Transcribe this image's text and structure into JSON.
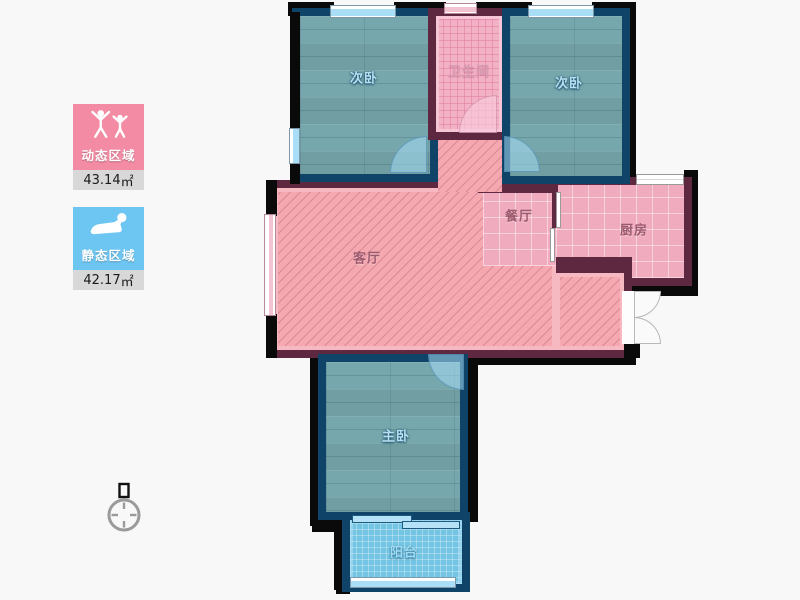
{
  "page": {
    "background": "#f8f8f8"
  },
  "legend": {
    "dynamic_zone": {
      "label": "动态区域",
      "area_value": "43.14",
      "area_unit": "㎡",
      "color": "#f28ba3",
      "icon": "active-people-icon"
    },
    "static_zone": {
      "label": "静态区域",
      "area_value": "42.17",
      "area_unit": "㎡",
      "color": "#6dc5f1",
      "icon": "resting-person-icon"
    }
  },
  "compass": {
    "icon": "north-compass-icon"
  },
  "floorplan": {
    "rooms": {
      "bedroom_top_left": {
        "label": "次卧",
        "type": "bedroom"
      },
      "bathroom": {
        "label": "卫生间",
        "type": "bathroom"
      },
      "bedroom_top_right": {
        "label": "次卧",
        "type": "bedroom"
      },
      "dining_room": {
        "label": "餐厅",
        "type": "dining"
      },
      "kitchen": {
        "label": "厨房",
        "type": "kitchen"
      },
      "living_room": {
        "label": "客厅",
        "type": "living"
      },
      "master_bedroom": {
        "label": "主卧",
        "type": "bedroom"
      },
      "balcony": {
        "label": "阳台",
        "type": "balcony"
      }
    },
    "colors": {
      "exterior_wall": "#0a0a0a",
      "bedroom_wall": "#0f4468",
      "pink_area_wall": "#5d2840",
      "bedroom_floor": "#76a7ac",
      "living_floor": "#f5a8b0",
      "bathroom_floor": "#f3b1c5",
      "kitchen_dining_floor": "#f0abbe",
      "balcony_floor": "#74c4e3",
      "window_glass": "#a9def6"
    }
  }
}
